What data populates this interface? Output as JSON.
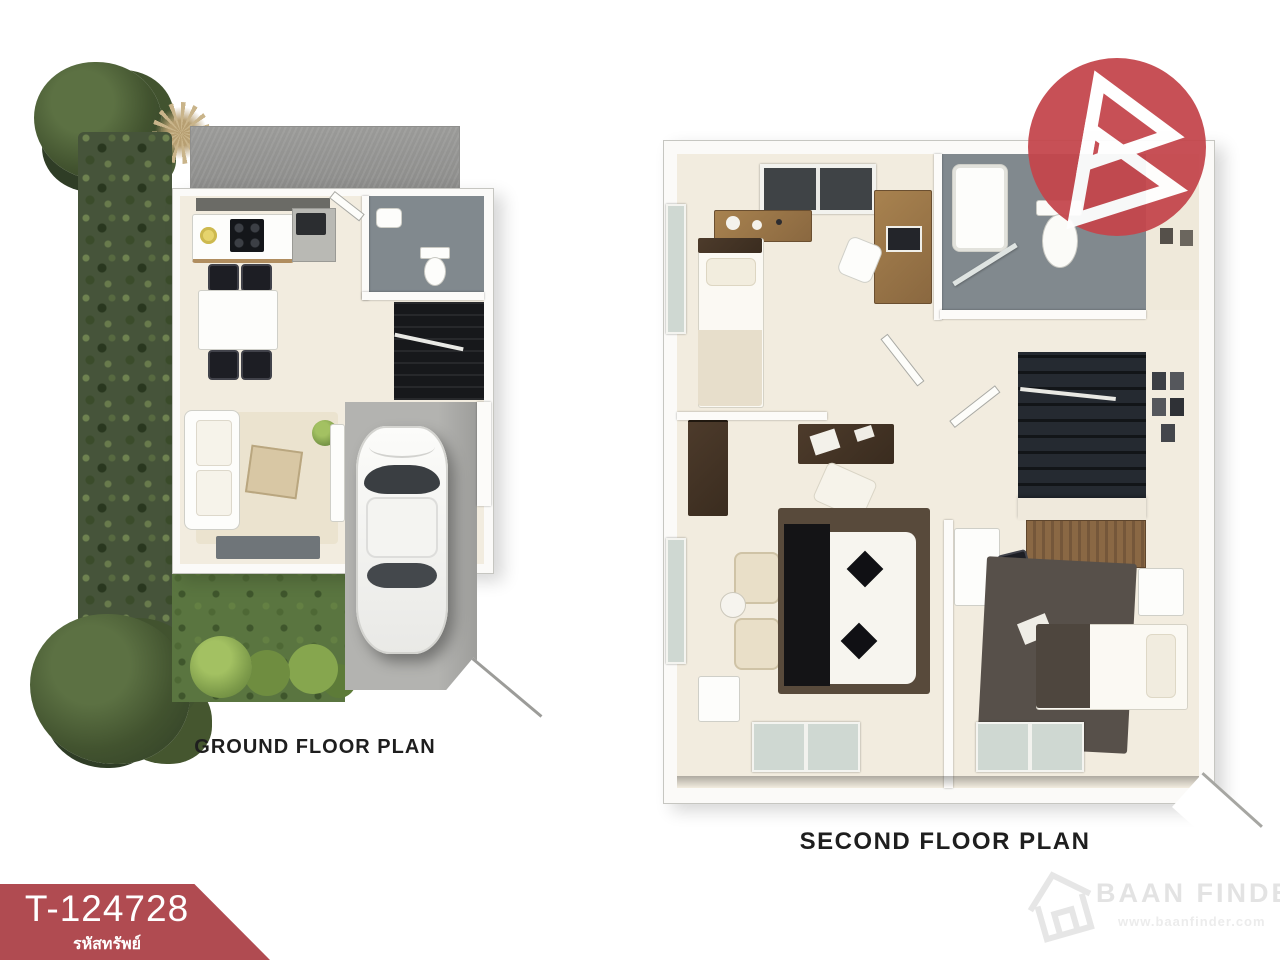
{
  "ground_floor": {
    "label": "GROUND FLOOR PLAN"
  },
  "second_floor": {
    "label": "SECOND FLOOR PLAN"
  },
  "property_banner": {
    "code": "T-124728",
    "caption": "รหัสทรัพย์",
    "bg_color": "#b04b51",
    "text_color": "#ffffff"
  },
  "logo": {
    "brand_initial": "B",
    "bg_color": "#c4464c",
    "glyph_color": "#ffffff"
  },
  "watermark": {
    "brand": "BAAN FINDER",
    "url": "www.baanfinder.com",
    "color": "#e3e3e3"
  },
  "illustration_colors": {
    "garden_green": "#46543a",
    "lawn_green": "#5a7540",
    "bush_green": "#7d9b4a",
    "roof_gray": "#a2a2a0",
    "floor_cream": "#f2ecdf",
    "bathroom_gray": "#81898e",
    "stair_dark": "#1c1f24",
    "driveway_gray": "#b3b3b0"
  }
}
